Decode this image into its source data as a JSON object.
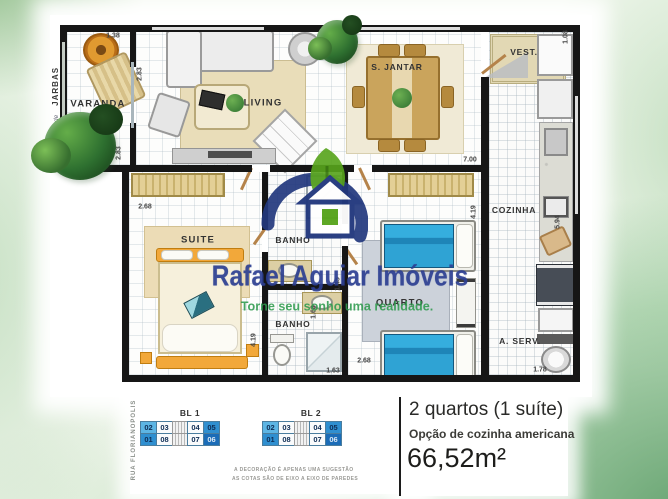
{
  "watermark": {
    "brand": "Rafael Aguiar Imóveis",
    "tagline": "Torne seu sonho uma realidade.",
    "brand_color": "#2c3f92",
    "tagline_color": "#2f9b4e",
    "logo": "leaf-house-logo"
  },
  "rooms": {
    "varanda": "VARANDA",
    "living": "LIVING",
    "jantar": "S. JANTAR",
    "vest": "VEST.",
    "cozinha": "COZINHA",
    "suite": "SUITE",
    "banho1": "BANHO",
    "banho2": "BANHO",
    "quarto": "QUARTO",
    "aserv": "A. SERV."
  },
  "dims": {
    "varanda_top": "1.38",
    "varanda_wall": "2.83",
    "varanda_bottom": "2.83",
    "vest_side": "1.08",
    "jantar_width": "7.00",
    "suite_width": "2.68",
    "suite_height": "4.19",
    "quarto_height": "4.19",
    "cozinha_height": "5.94",
    "banho1_height": "1.45",
    "banho2_height": "1.68",
    "banho2_width": "1.63",
    "quarto_width": "2.68",
    "aserv_width": "1.78"
  },
  "streets": {
    "top_left_small": "R. Saudade",
    "top_left": "JARBAS",
    "bottom_left": "RUA  FLORIANOPOLIS"
  },
  "legend": {
    "blocks": [
      {
        "name": "BL 1",
        "top": [
          "02",
          "03",
          "04",
          "05"
        ],
        "bottom": [
          "01",
          "08",
          "07",
          "06"
        ]
      },
      {
        "name": "BL 2",
        "top": [
          "02",
          "03",
          "04",
          "05"
        ],
        "bottom": [
          "01",
          "08",
          "07",
          "06"
        ]
      }
    ],
    "unit_colors": {
      "light_blue": "#5db5e4",
      "mid_blue": "#2f8fd0",
      "dark_blue": "#1b6cb7"
    },
    "disclaimer1": "A DECORAÇÃO É APENAS UMA SUGESTÃO",
    "disclaimer2": "AS COTAS SÃO DE EIXO A EIXO DE PAREDES"
  },
  "summary": {
    "title": "2 quartos (1 suíte)",
    "subtitle": "Opção de cozinha americana",
    "area": "66,52m²"
  }
}
